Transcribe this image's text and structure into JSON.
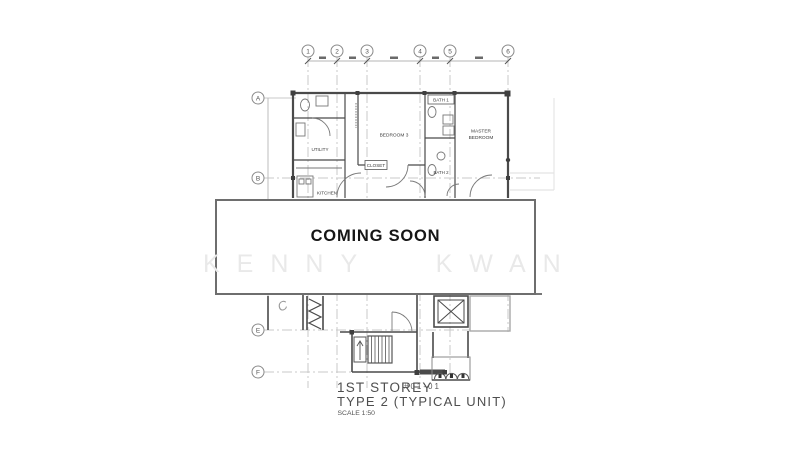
{
  "overlay": {
    "message": "COMING SOON"
  },
  "watermark": {
    "text": "KENNY KWAN"
  },
  "plan": {
    "grid": {
      "columns": [
        "1",
        "2",
        "3",
        "4",
        "5",
        "6"
      ],
      "rows": [
        "A",
        "B",
        "E",
        "F"
      ]
    },
    "rooms": {
      "utility": "UTILITY",
      "bedroom": "BEDROOM 3",
      "bath1": "BATH 1",
      "bath2": "BATH 2",
      "master_line1": "MASTER",
      "master_line2": "BEDROOM",
      "closet": "CLOSET",
      "kitchen": "KITCHEN"
    },
    "annotation": "C",
    "title": {
      "storey": "1ST STOREY",
      "unit_no": "#01-01",
      "type_line": "TYPE 2 (TYPICAL UNIT)",
      "scale_line": "SCALE 1:50"
    }
  },
  "colors": {
    "wall": "#4a4a4a",
    "grid_line": "#c8c8c8",
    "overlay_border": "#6e6e6e",
    "watermark": "#e9e9e9",
    "annex_gray": "#a8a8a8"
  }
}
